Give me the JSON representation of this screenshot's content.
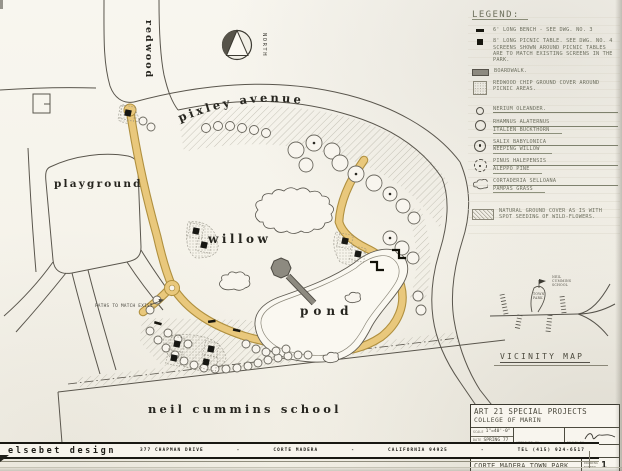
{
  "colors": {
    "paper": "#f7f4ec",
    "ink": "#55524a",
    "label_ink": "#26251f",
    "pencil": "#6e7060",
    "path_tan": "#e9c87c",
    "path_edge": "#b0903f",
    "boardwalk_gray": "#8d8a80"
  },
  "plan": {
    "labels": {
      "redwood": "redwood",
      "pixley": "pixley avenue",
      "playground": "playground",
      "willow": "willow",
      "pond": "pond",
      "school": "neil cummins school"
    },
    "paths_note": "PATHS TO MATCH EXIST.",
    "north": "NORTH"
  },
  "legend": {
    "title": "LEGEND:",
    "items": [
      {
        "icon": "bench-dash-icon",
        "line1": "6' LONG BENCH - SEE DWG. NO. 3"
      },
      {
        "icon": "picnic-table-icon",
        "line1": "8' LONG PICNIC TABLE. SEE DWG. NO. 4",
        "note": "SCREENS SHOWN AROUND PICNIC TABLES ARE TO MATCH EXISTING SCREENS IN THE PARK."
      },
      {
        "icon": "boardwalk-icon",
        "line1": "BOARDWALK."
      },
      {
        "icon": "chip-ground-icon",
        "line1": "REDWOOD CHIP GROUND COVER AROUND PICNIC AREAS."
      },
      {
        "icon": "oleander-circle-icon",
        "line1": "NERIUM OLEANDER."
      },
      {
        "icon": "buckthorn-circle-icon",
        "line1": "RHAMNUS ALATERNUS",
        "line2": "ITALIEN BUCKTHORN"
      },
      {
        "icon": "willow-circle-icon",
        "line1": "SALIX BABYLONICA",
        "line2": "WEEPING WILLOW"
      },
      {
        "icon": "pine-circle-icon",
        "line1": "PINUS HALEPENSIS",
        "line2": "ALEPPO PINE"
      },
      {
        "icon": "pampas-blob-icon",
        "line1": "CORTADERIA SELLOANA",
        "line2": "PAMPAS GRASS"
      },
      {
        "icon": "ground-cover-hatch-icon",
        "line1": "NATURAL GROUND COVER AS IS WITH SPOT SEEDING OF WILD-FLOWERS."
      }
    ]
  },
  "vicinity": {
    "title": "VICINITY MAP",
    "park_line1": "TOWN",
    "park_line2": "PARK",
    "school_line1": "NEIL",
    "school_line2": "CUMMINS",
    "school_line3": "SCHOOL"
  },
  "title_block": {
    "project": "ART 21 SPECIAL PROJECTS",
    "organization": "COLLEGE OF MARIN",
    "scale_label": "SCALE",
    "scale_value": "1\"=40'-0\"",
    "date_label": "DATE",
    "date_value": "SPRING 77",
    "approved_label": "APPROVED BY",
    "drawn_label": "DRAWN BY",
    "sheet_title": "LANDSCAPE PLAN - WILLOW POND",
    "park_title": "CORTE MADERA TOWN PARK",
    "number_label": "DRAWING NUMBER",
    "number_value": "1"
  },
  "footer": {
    "firm": "elsebet design",
    "parts": [
      "377 CHAPMAN DRIVE",
      "-",
      "CORTE MADERA",
      "-",
      "CALIFORNIA 94925",
      "-",
      "TEL (415) 924-6517"
    ]
  }
}
